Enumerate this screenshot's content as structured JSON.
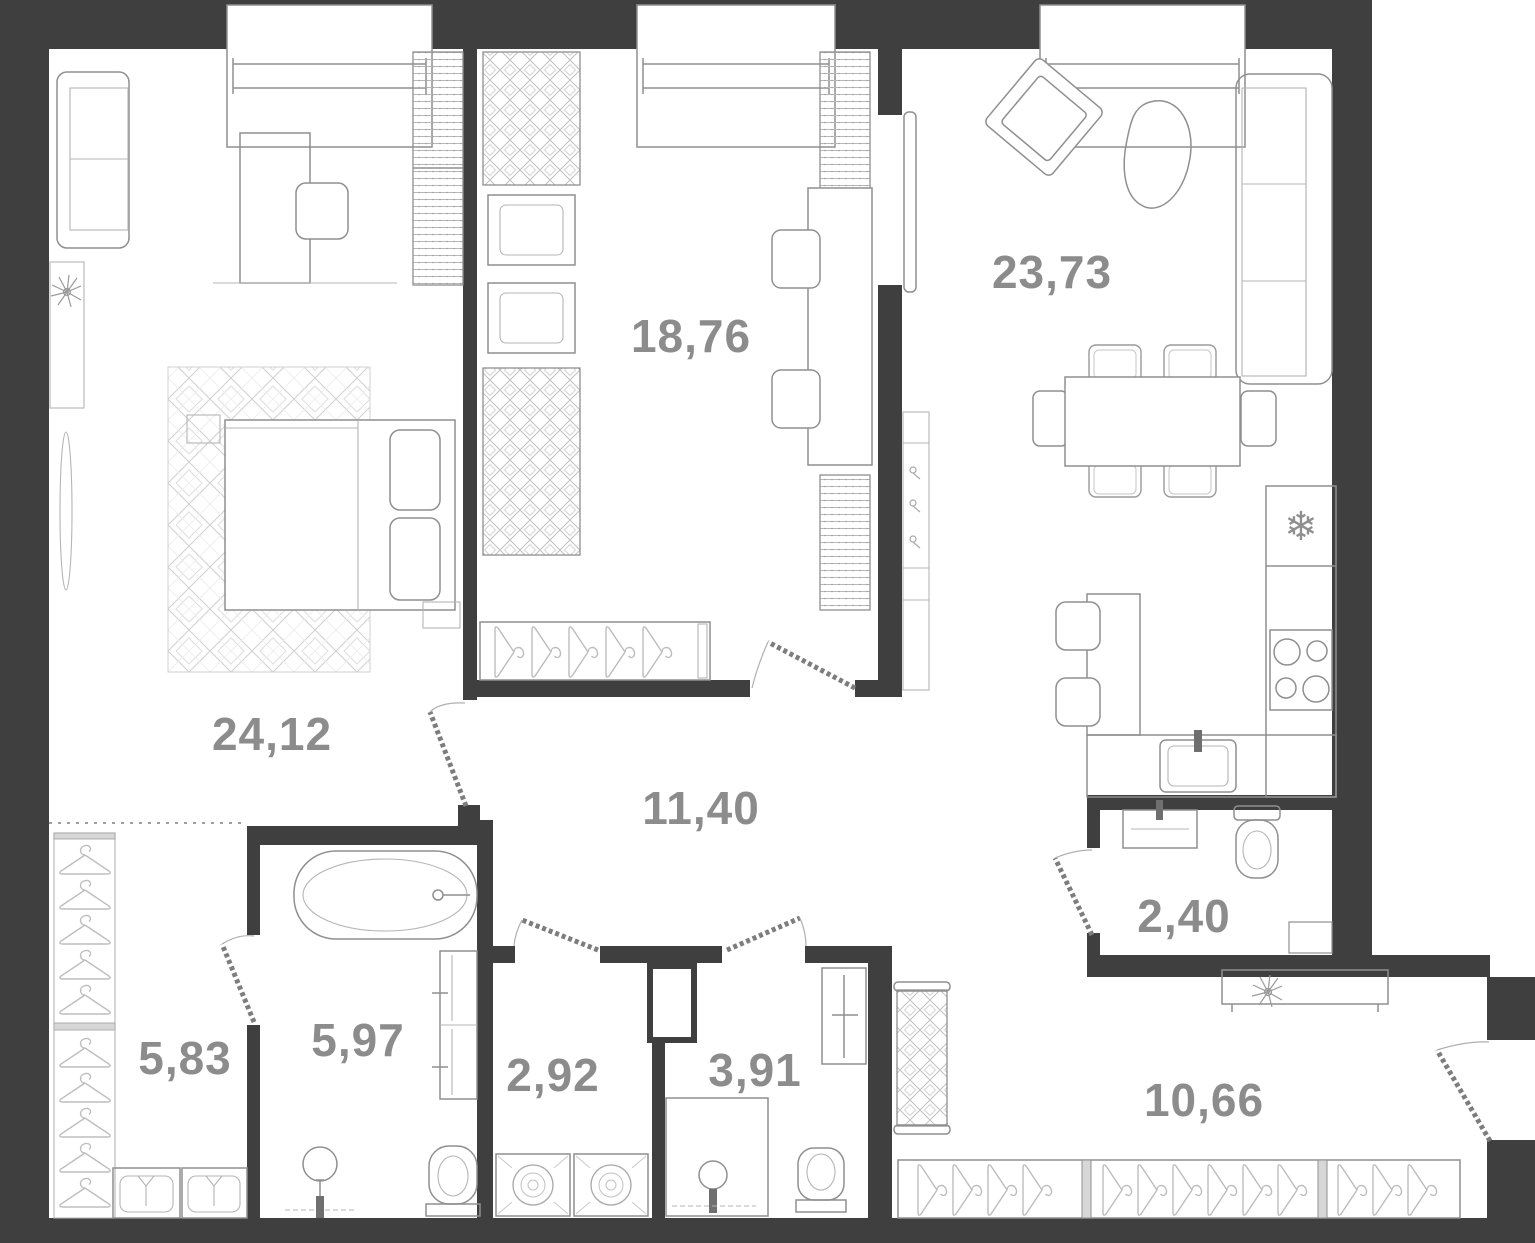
{
  "plan": {
    "type": "apartment-floor-plan",
    "rooms": [
      {
        "id": "bedroom-main",
        "area": "24,12"
      },
      {
        "id": "bedroom-study",
        "area": "18,76"
      },
      {
        "id": "living-kitchen",
        "area": "23,73"
      },
      {
        "id": "hallway",
        "area": "11,40"
      },
      {
        "id": "closet",
        "area": "5,83"
      },
      {
        "id": "bathroom",
        "area": "5,97"
      },
      {
        "id": "laundry",
        "area": "2,92"
      },
      {
        "id": "shower-wc",
        "area": "3,91"
      },
      {
        "id": "guest-wc",
        "area": "2,40"
      },
      {
        "id": "entry-hall",
        "area": "10,66"
      }
    ],
    "icons": {
      "fridge_snowflake": "❄"
    },
    "colors": {
      "wall": "#3f3f3f",
      "furniture_line": "#8f8f8f",
      "pattern_line": "#c6c6c6",
      "label": "#8c8c8c",
      "background": "#ffffff"
    }
  }
}
